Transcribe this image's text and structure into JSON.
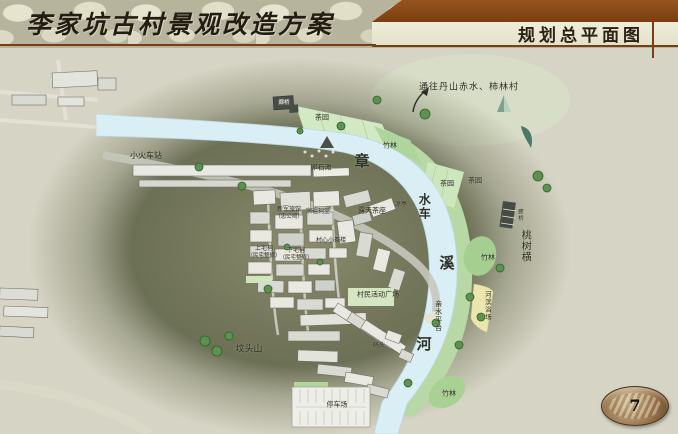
{
  "header": {
    "title_left": "李家坑古村景观改造方案",
    "title_right": "规划总平面图"
  },
  "page_number": "7",
  "colors": {
    "accent_brown": "#8a4a1e",
    "river_blue": "#d9eef5",
    "bank_green": "#b8d9a5",
    "bamboo_green": "#aed69c",
    "beach_yellow": "#ebe6ae",
    "hill_olive": "#6e7257",
    "tree_green": "#5c9150"
  },
  "map": {
    "route_note": "通往丹山赤水、柿林村",
    "river_name": "章溪河",
    "labels": [
      {
        "text": "小火车站",
        "x": 146,
        "y": 156,
        "size": 8
      },
      {
        "text": "廊桥",
        "x": 284,
        "y": 104,
        "size": 5.5,
        "color": "#f2f2ea"
      },
      {
        "text": "茶园",
        "x": 322,
        "y": 118,
        "size": 7
      },
      {
        "text": "竹林",
        "x": 390,
        "y": 146,
        "size": 7
      },
      {
        "text": "卵石滩",
        "x": 321,
        "y": 168,
        "size": 7
      },
      {
        "text": "章",
        "x": 363,
        "y": 162,
        "size": 15,
        "cls": "river"
      },
      {
        "text": "水车",
        "x": 424,
        "y": 207,
        "size": 12,
        "vertical": true,
        "cls": "river"
      },
      {
        "text": "溪",
        "x": 448,
        "y": 264,
        "size": 15,
        "cls": "river"
      },
      {
        "text": "河",
        "x": 425,
        "y": 345,
        "size": 15,
        "cls": "river"
      },
      {
        "text": "茶园",
        "x": 447,
        "y": 184,
        "size": 7
      },
      {
        "text": "茶园",
        "x": 475,
        "y": 181,
        "size": 7
      },
      {
        "text": "凉亭",
        "x": 401,
        "y": 205,
        "size": 6
      },
      {
        "text": "露天茶座",
        "x": 372,
        "y": 211,
        "size": 7
      },
      {
        "text": "新军旅馆",
        "x": 289,
        "y": 210,
        "size": 6
      },
      {
        "text": "（忠公祠）",
        "x": 289,
        "y": 218,
        "size": 5.5
      },
      {
        "text": "宗祖祠堂",
        "x": 318,
        "y": 212,
        "size": 6
      },
      {
        "text": "村心小茶楼",
        "x": 331,
        "y": 241,
        "size": 6
      },
      {
        "text": "上宅祠",
        "x": 264,
        "y": 249,
        "size": 6
      },
      {
        "text": "（民宅整修）",
        "x": 264,
        "y": 257,
        "size": 5.5
      },
      {
        "text": "下宅祠",
        "x": 296,
        "y": 251,
        "size": 6
      },
      {
        "text": "（民宅整修）",
        "x": 296,
        "y": 259,
        "size": 5.5
      },
      {
        "text": "廊桥",
        "x": 519,
        "y": 215,
        "size": 5.5,
        "vertical": true
      },
      {
        "text": "桃树横",
        "x": 524,
        "y": 246,
        "size": 10,
        "vertical": true
      },
      {
        "text": "竹林",
        "x": 488,
        "y": 258,
        "size": 7
      },
      {
        "text": "河滨浴场",
        "x": 487,
        "y": 306,
        "size": 6.5,
        "vertical": true
      },
      {
        "text": "亲水平台",
        "x": 438,
        "y": 316,
        "size": 7,
        "vertical": true
      },
      {
        "text": "村民活动广场",
        "x": 378,
        "y": 295,
        "size": 7
      },
      {
        "text": "码头",
        "x": 379,
        "y": 346,
        "size": 6
      },
      {
        "text": "坟头山",
        "x": 249,
        "y": 350,
        "size": 9
      },
      {
        "text": "停车场",
        "x": 337,
        "y": 405,
        "size": 7
      },
      {
        "text": "竹林",
        "x": 449,
        "y": 394,
        "size": 7
      },
      {
        "text": "通往丹山赤水、柿林村",
        "x": 469,
        "y": 88,
        "size": 9,
        "cls": "route"
      }
    ]
  }
}
